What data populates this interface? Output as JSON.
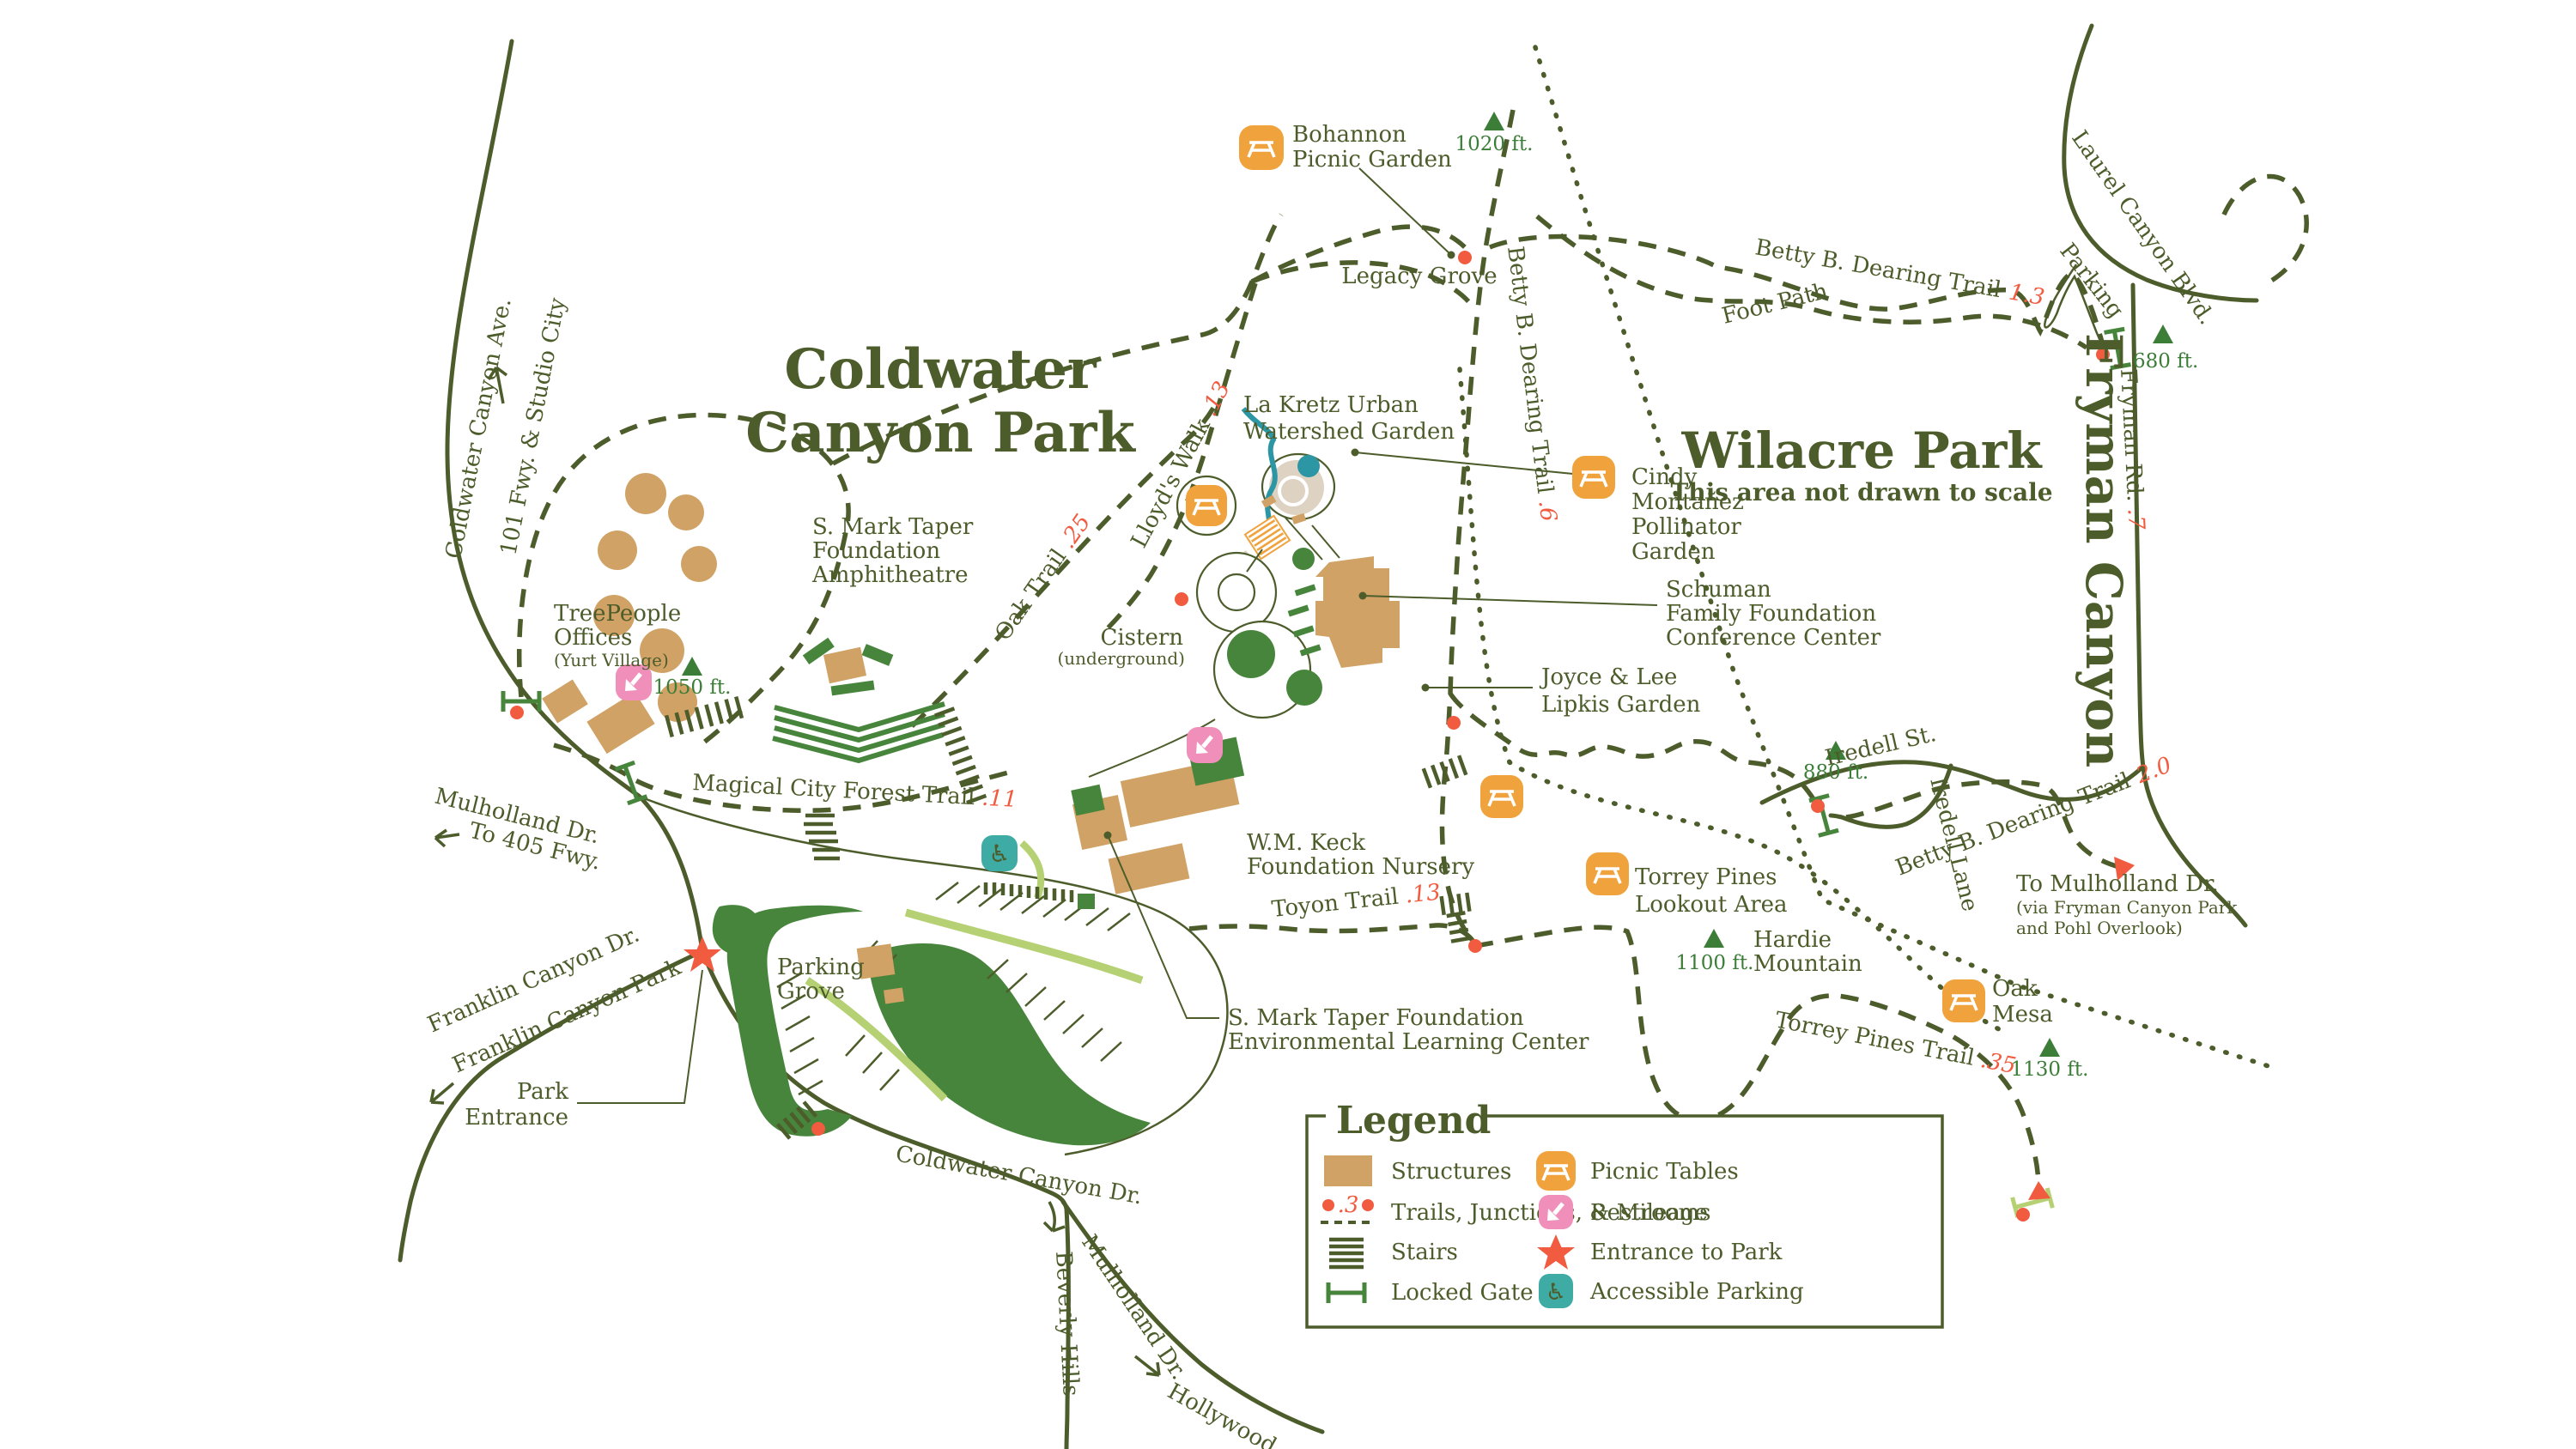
{
  "colors": {
    "ink": "#4d5c2b",
    "orangeIcon": "#f0a23d",
    "red": "#f15b40",
    "tan": "#d0a266",
    "green": "#48853c",
    "lightGreen": "#b5d173",
    "pink": "#ef8fba",
    "teal": "#3eaca4",
    "stream": "#2d96a5",
    "sand": "#ded2c2"
  },
  "titles": {
    "coldwater1": "Coldwater",
    "coldwater2": "Canyon Park",
    "wilacre": "Wilacre Park",
    "wilacreNote": "This area not drawn to scale",
    "fryman": "Fryman Canyon"
  },
  "roads": {
    "coldwaterAve": "Coldwater Canyon Ave.",
    "freeway": "101 Fwy. & Studio City",
    "laurel": "Laurel Canyon Blvd.",
    "parking": "Parking",
    "frymanRd": "Fryman Rd.",
    "frymanRdMiles": ".7",
    "iredellSt": "Iredell St.",
    "iredellLane": "Iredell Lane",
    "mulhollandW": "Mulholland Dr.",
    "to405": "To 405 Fwy.",
    "franklinDr": "Franklin Canyon Dr.",
    "franklinPark": "Franklin Canyon Park",
    "coldwaterDr": "Coldwater Canyon Dr.",
    "beverly": "Beverly Hills",
    "mulhollandSE": "Mulholland Dr.",
    "hollywood": "Hollywood"
  },
  "trails": {
    "dearing13": {
      "name": "Betty B. Dearing Trail",
      "miles": "1.3"
    },
    "footPath": "Foot Path",
    "dearing6": {
      "name": "Betty B. Dearing Trail",
      "miles": ".6"
    },
    "dearing20": {
      "name": "Betty B. Dearing Trail",
      "miles": "2.0"
    },
    "oak": {
      "name": "Oak Trail",
      "miles": ".25"
    },
    "lloyds": {
      "name": "Lloyd's Walk",
      "miles": ".13"
    },
    "magical": {
      "name": "Magical City Forest Trail",
      "miles": ".11"
    },
    "toyon": {
      "name": "Toyon Trail",
      "miles": ".13"
    },
    "torrey": {
      "name": "Torrey Pines Trail",
      "miles": ".35"
    }
  },
  "places": {
    "bohannon": [
      "Bohannon",
      "Picnic Garden"
    ],
    "legacyGrove": "Legacy Grove",
    "laKretz": [
      "La Kretz Urban",
      "Watershed Garden"
    ],
    "cindy": [
      "Cindy",
      "Montañez",
      "Pollinator",
      "Garden"
    ],
    "schuman": [
      "Schuman",
      "Family Foundation",
      "Conference Center"
    ],
    "joyce": [
      "Joyce & Lee",
      "Lipkis Garden"
    ],
    "cistern": [
      "Cistern",
      "(underground)"
    ],
    "treePeople": [
      "TreePeople",
      "Offices",
      "(Yurt Village)"
    ],
    "taperAmphi": [
      "S. Mark Taper",
      "Foundation",
      "Amphitheatre"
    ],
    "keck": [
      "W.M. Keck",
      "Foundation Nursery"
    ],
    "taperELC": [
      "S. Mark Taper Foundation",
      "Environmental Learning Center"
    ],
    "parkingGrove": [
      "Parking",
      "Grove"
    ],
    "parkEntrance": [
      "Park",
      "Entrance"
    ],
    "torreyLookout": [
      "Torrey Pines",
      "Lookout Area"
    ],
    "hardie": [
      "Hardie",
      "Mountain"
    ],
    "oakMesa": [
      "Oak",
      "Mesa"
    ],
    "toMulholland": [
      "To Mulholland Dr.",
      "(via Fryman Canyon Park",
      "and Pohl Overlook)"
    ]
  },
  "elevations": {
    "e1020": "1020 ft.",
    "e1050": "1050 ft.",
    "e680": "680 ft.",
    "e880": "880 ft.",
    "e1100": "1100 ft.",
    "e1130": "1130 ft."
  },
  "legend": {
    "title": "Legend",
    "mileageSample": ".3",
    "items": {
      "structures": "Structures",
      "trails": "Trails, Junctions, & Mileage",
      "stairs": "Stairs",
      "gate": "Locked Gate",
      "picnic": "Picnic Tables",
      "restrooms": "Restrooms",
      "entrance": "Entrance to Park",
      "accessible": "Accessible Parking"
    }
  }
}
